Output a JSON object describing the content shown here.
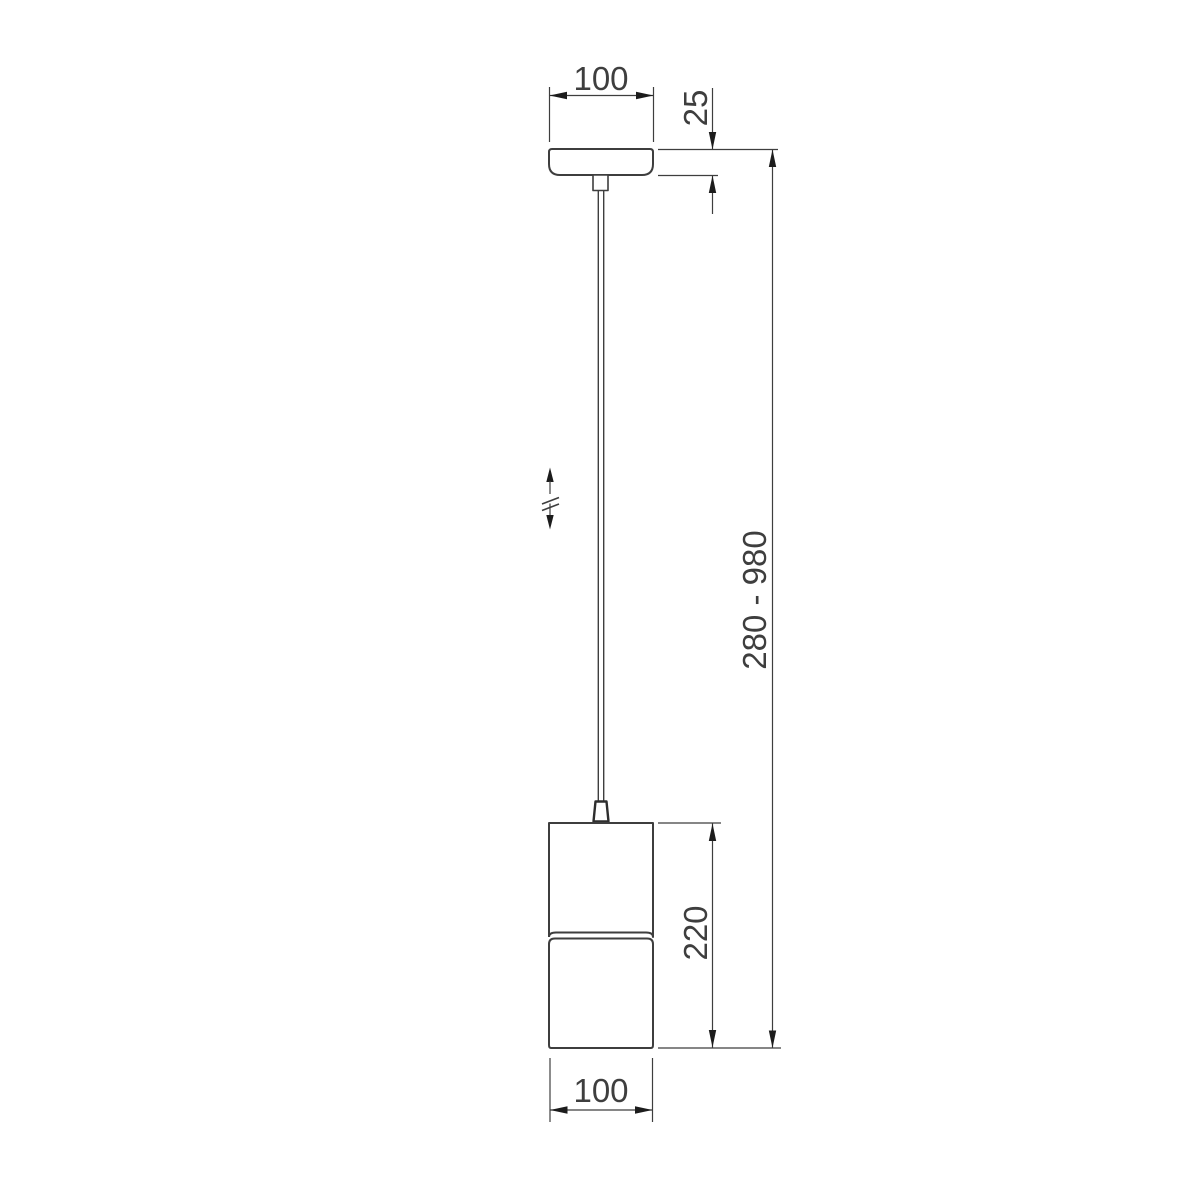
{
  "drawing": {
    "kind": "pendant-lamp-dimension-drawing",
    "dim_labels": {
      "canopy_width": "100",
      "canopy_height": "25",
      "overall_height": "280 - 980",
      "body_height": "220",
      "body_width": "100"
    },
    "symbols": {
      "height_adjustable": "double-arrow-with-break"
    },
    "colors": {
      "background": "#ffffff",
      "line": "#3e3e3e",
      "line_dark": "#2e2e2e",
      "arrow": "#1c1c1c",
      "text": "#3e3e3e"
    }
  }
}
